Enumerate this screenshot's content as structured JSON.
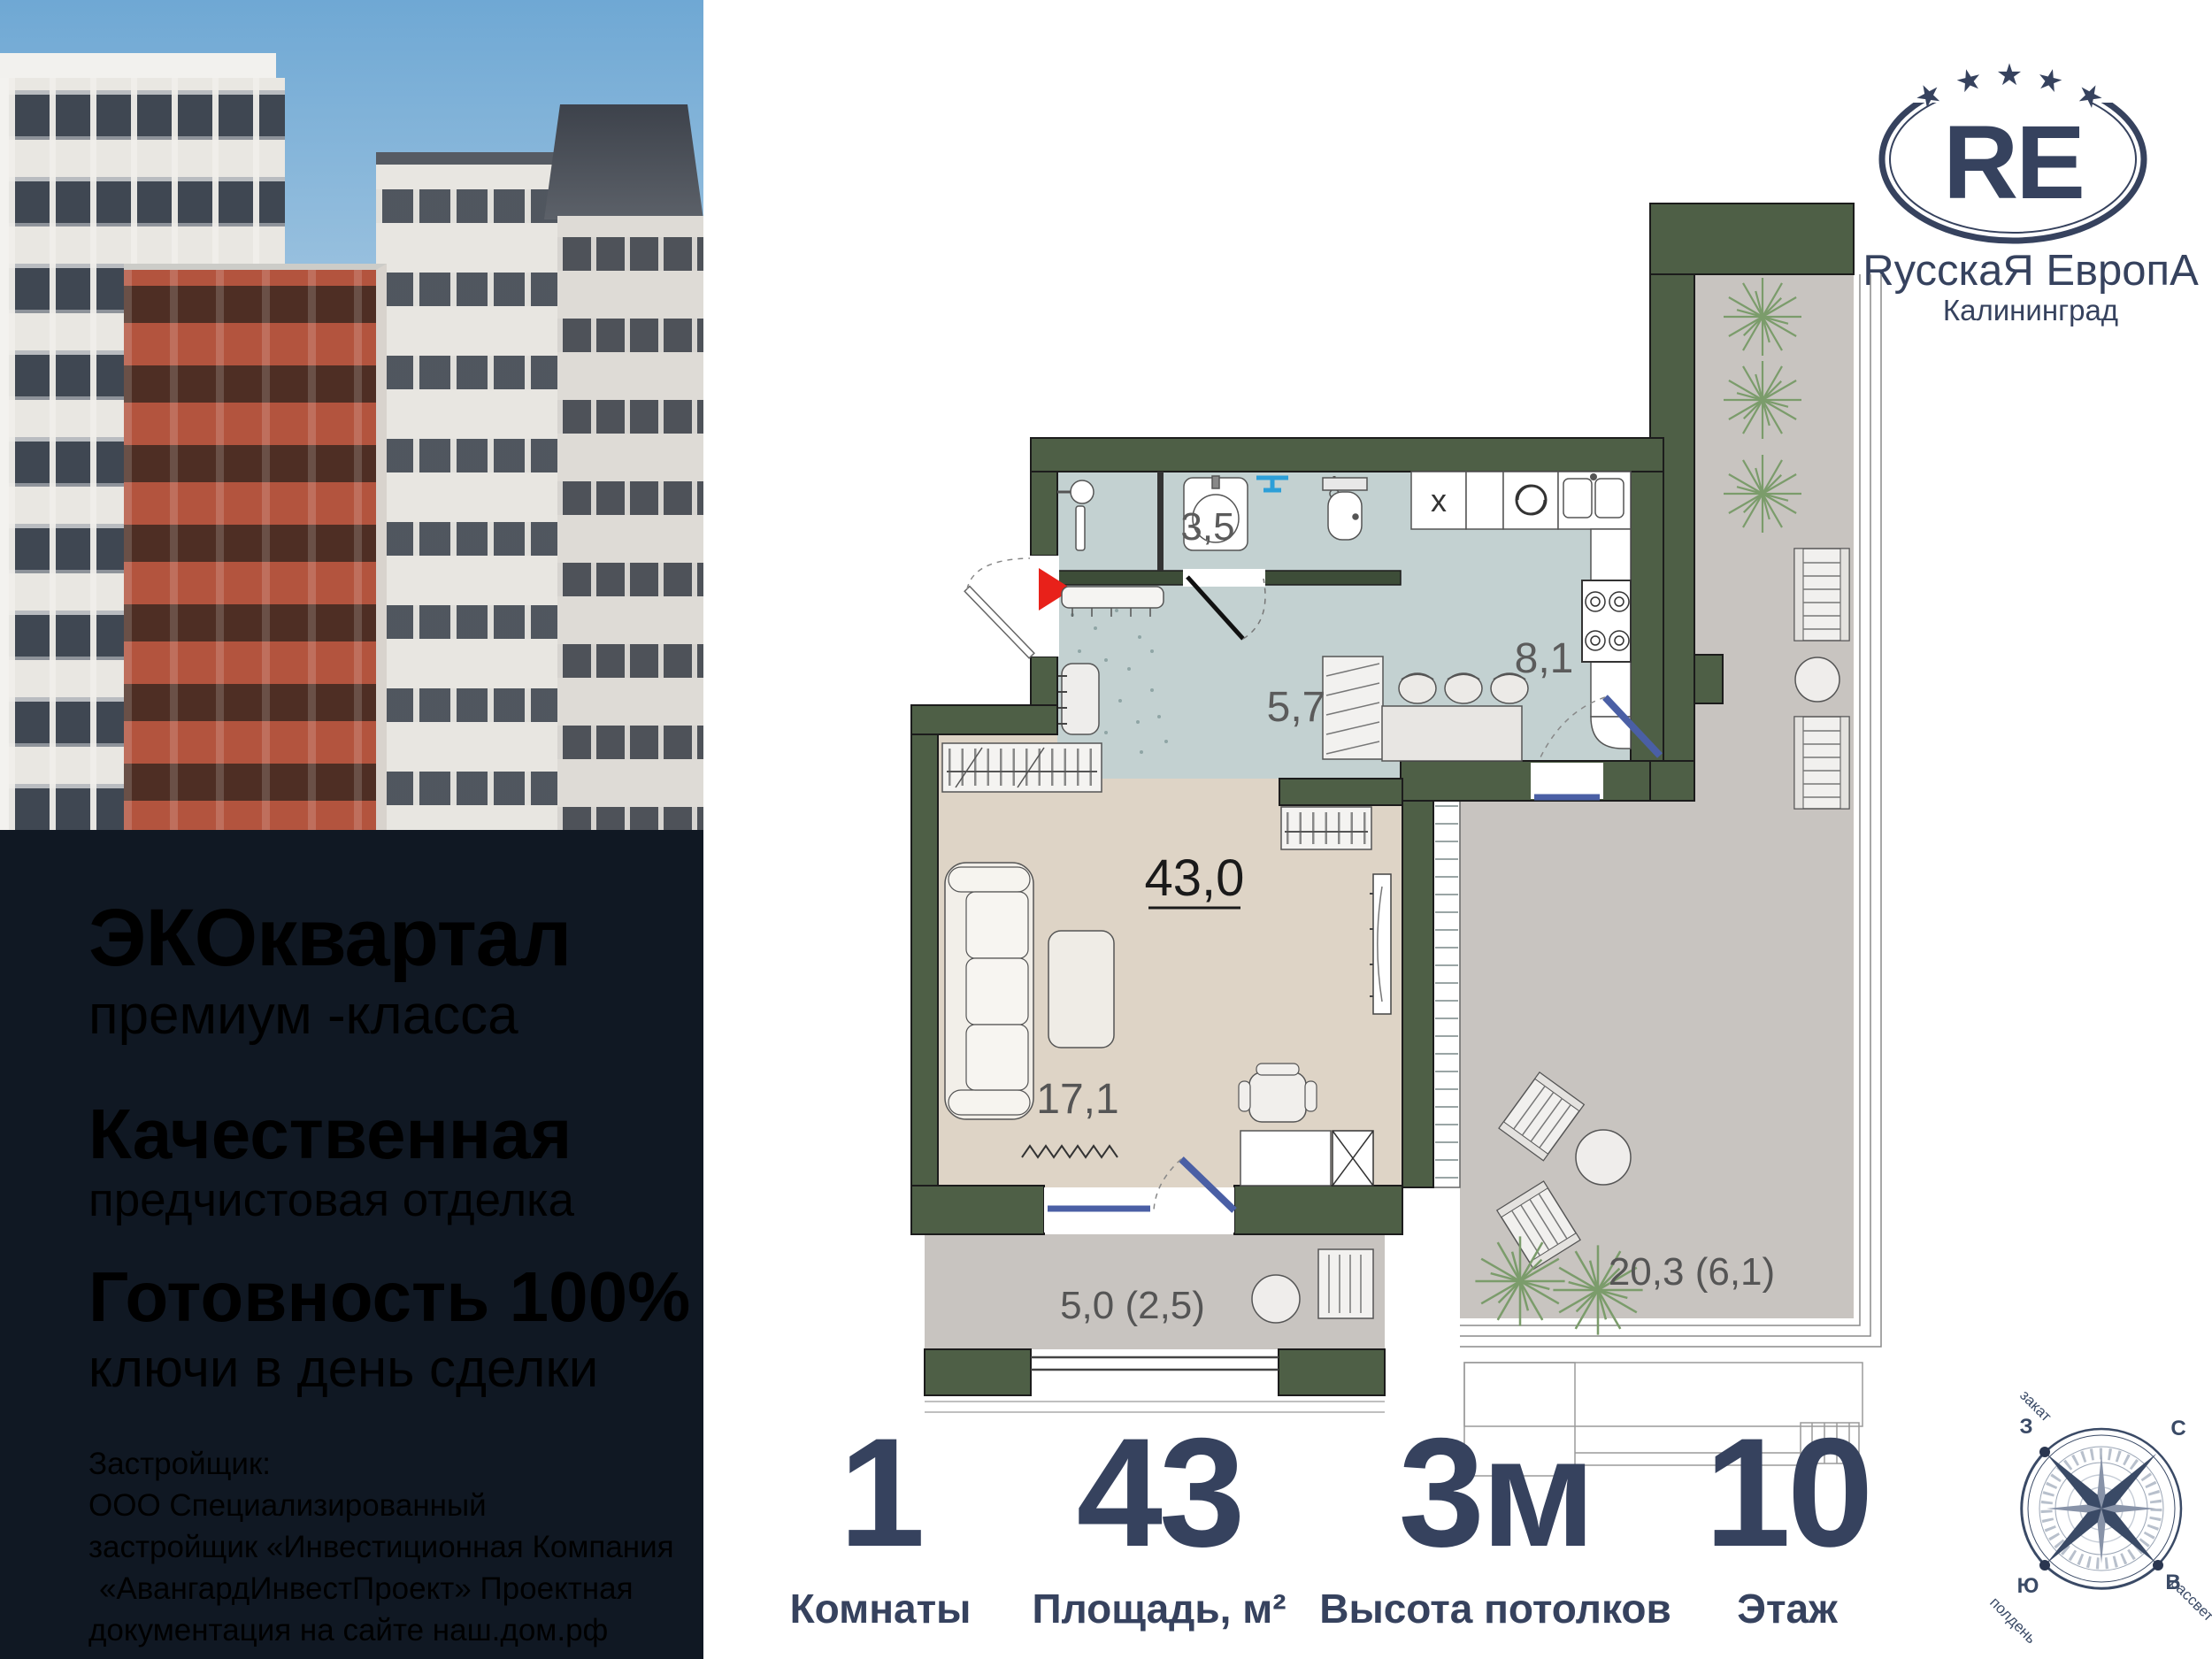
{
  "brand": {
    "initials": "RE",
    "name": "RусскаЯ ЕвропА",
    "city": "Калининград",
    "star": "★"
  },
  "promo": {
    "line1_bold": "ЭКОквартал",
    "line1_sub": "премиум -класса",
    "line2_bold": "Качественная",
    "line2_sub": "предчистовая отделка",
    "line3_bold": "Готовность 100%",
    "line3_sub": "ключи в день сделки",
    "developer": [
      "Застройщик:",
      "ООО Специализированный",
      "застройщик «Инвестиционная Компания",
      "«АвангардИнвестПроект» Проектная",
      "документация на сайте наш.дом.рф"
    ]
  },
  "floor_plan": {
    "total_area_label": "43,0",
    "kitchen_mark": "x",
    "areas": {
      "bathroom": "3,5",
      "hallway": "5,7",
      "kitchen": "8,1",
      "living": "17,1",
      "balcony": "5,0 (2,5)",
      "terrace": "20,3 (6,1)"
    }
  },
  "stats": [
    {
      "value": "1",
      "label": "Комнаты"
    },
    {
      "value": "43",
      "label": "Площадь, м²"
    },
    {
      "value": "3м",
      "label": "Высота потолков"
    },
    {
      "value": "10",
      "label": "Этаж"
    }
  ],
  "compass": {
    "north": "С",
    "east": "В",
    "south": "Ю",
    "west": "З",
    "sunset": "закат",
    "noon": "полдень",
    "dawn": "рассвет"
  },
  "colors": {
    "brand_navy": "#36425e",
    "panel_dark": "#101823",
    "wall_green": "#4e5f46",
    "wet_floor": "#c3d1d1",
    "living_floor": "#ded4c6",
    "terrace_floor": "#c8c4c0",
    "door_blue": "#4a5fa5",
    "towel_blue": "#2d9fd8",
    "entry_arrow_red": "#e8211a"
  }
}
